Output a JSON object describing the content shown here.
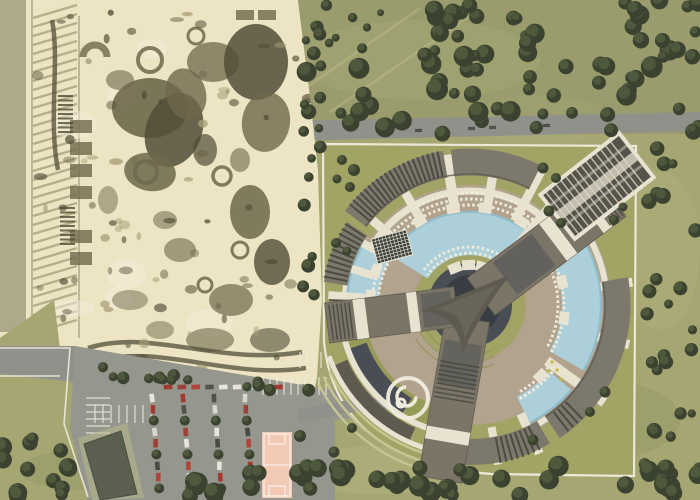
{
  "page": {
    "kind": "aerial-masterplan-rendering",
    "width": 700,
    "height": 500
  },
  "palette": {
    "grass": "#a5a672",
    "forest_field": "#9a9c6d",
    "lawn_light": "#c6c493",
    "lawn_dark": "#8e9254",
    "tree_dark": "#3b4330",
    "tree_mid": "#525c3e",
    "tree_light": "#66714b",
    "sepia_bg": "#ece4c3",
    "ink": "#6f684c",
    "shadow": "#514d38",
    "mid": "#a79e77",
    "sepia_light": "#f4eedd",
    "road": "#90918a",
    "asphalt": "#95968e",
    "line_white": "#f0ecdd",
    "path_white": "#e8e2d0",
    "site_lawn": "#a2a465",
    "deck": "#b1a38d",
    "pool": "#accfd9",
    "pool_deep": "#8fbccb",
    "roof": "#7d786c",
    "roof_dark": "#5e5a50",
    "louver": "#44433b",
    "glass": "#494d54",
    "glass_dark": "#383c43",
    "arm": "#7a7567",
    "court": "#f1c9b4",
    "bldg": "#5b5f50",
    "pad_green": "#b7ba86",
    "car_colors": [
      "#e8e6db",
      "#a23a30",
      "#50544b",
      "#d9d7cd",
      "#9c4038",
      "#e8e6db",
      "#474b43",
      "#b0443a"
    ],
    "yellow_dot": "#c9b94a"
  },
  "scene": {
    "forest_field_rect": [
      282,
      0,
      418,
      134
    ],
    "field_streaks": [
      [
        300,
        92,
        420,
        8
      ],
      [
        330,
        112,
        470,
        16
      ]
    ],
    "mottles": [
      [
        120,
        200,
        90,
        50,
        "#d8d6a6"
      ],
      [
        200,
        320,
        70,
        40,
        "#6f7348"
      ],
      [
        420,
        60,
        120,
        40,
        "#c9c795"
      ],
      [
        600,
        420,
        80,
        40,
        "#6f7348"
      ],
      [
        380,
        470,
        100,
        24,
        "#d8d6a6"
      ],
      [
        660,
        250,
        40,
        80,
        "#c9c795"
      ],
      [
        80,
        470,
        60,
        20,
        "#6f7348"
      ],
      [
        540,
        120,
        70,
        25,
        "#b8b787"
      ]
    ],
    "top_road": "M285,121 L700,112 L700,131 L285,141 Z",
    "road_cars": [
      [
        468,
        127
      ],
      [
        489,
        126
      ],
      [
        543,
        124
      ],
      [
        415,
        129
      ]
    ],
    "park": {
      "clip": "0,0 298,0 310,96 318,170 322,300 317,378 306,428 235,422 120,398 60,350 54,300 0,338",
      "left_strip": [
        0,
        0,
        26,
        332
      ],
      "hatch": {
        "y0": 18,
        "y1": 336,
        "dy": 9,
        "x1": 33,
        "x2": 77,
        "drop": 13
      },
      "blobs": [
        [
          150,
          108,
          38,
          30,
          0,
          "ink",
          0.9
        ],
        [
          174,
          130,
          28,
          38,
          20,
          "shadow",
          0.85
        ],
        [
          186,
          94,
          20,
          26,
          -15,
          "ink",
          0.8
        ],
        [
          150,
          172,
          26,
          19,
          10,
          "ink",
          0.85
        ],
        [
          213,
          62,
          26,
          20,
          0,
          "ink",
          0.75
        ],
        [
          256,
          62,
          32,
          38,
          0,
          "shadow",
          0.85
        ],
        [
          266,
          122,
          24,
          30,
          8,
          "ink",
          0.8
        ],
        [
          250,
          212,
          20,
          27,
          0,
          "ink",
          0.85
        ],
        [
          272,
          262,
          18,
          23,
          0,
          "shadow",
          0.8
        ],
        [
          231,
          300,
          22,
          16,
          0,
          "ink",
          0.7
        ],
        [
          180,
          250,
          16,
          12,
          0,
          "ink",
          0.6
        ],
        [
          120,
          80,
          14,
          10,
          0,
          "ink",
          0.6
        ],
        [
          205,
          150,
          12,
          16,
          0,
          "shadow",
          0.7
        ],
        [
          240,
          160,
          10,
          12,
          0,
          "ink",
          0.6
        ],
        [
          165,
          220,
          12,
          9,
          0,
          "ink",
          0.55
        ],
        [
          130,
          300,
          18,
          10,
          0,
          "ink",
          0.5
        ],
        [
          210,
          340,
          24,
          12,
          0,
          "ink",
          0.6
        ],
        [
          270,
          340,
          20,
          12,
          0,
          "shadow",
          0.6
        ],
        [
          160,
          330,
          14,
          9,
          0,
          "ink",
          0.5
        ],
        [
          108,
          200,
          10,
          14,
          0,
          "ink",
          0.5
        ]
      ],
      "rings": [
        [
          150,
          60,
          12,
          4
        ],
        [
          146,
          172,
          11,
          4
        ],
        [
          222,
          176,
          9,
          3.5
        ],
        [
          196,
          36,
          8,
          3
        ],
        [
          240,
          250,
          8,
          3
        ],
        [
          205,
          285,
          7,
          3
        ]
      ],
      "halfring": [
        95,
        57,
        12,
        7
      ],
      "rects": [
        [
          70,
          120,
          22,
          13
        ],
        [
          70,
          142,
          22,
          13
        ],
        [
          70,
          164,
          22,
          13
        ],
        [
          70,
          186,
          22,
          13
        ],
        [
          70,
          230,
          22,
          13
        ],
        [
          70,
          252,
          22,
          13
        ],
        [
          236,
          10,
          18,
          10
        ],
        [
          258,
          10,
          18,
          10
        ]
      ],
      "tracks": [
        "M88,348 C150,328 220,366 302,352",
        "M92,362 C158,342 228,380 306,368",
        "M98,378 C168,358 238,396 308,386",
        "M52,20 C60,60 48,120 58,170"
      ],
      "ladders": [
        {
          "x": 58,
          "y": 96,
          "n": 9
        },
        {
          "x": 60,
          "y": 208,
          "n": 9
        }
      ],
      "speckles": {
        "n": 95,
        "seed": 41,
        "x": 34,
        "y": 6,
        "w": 276,
        "h": 414
      },
      "lights": {
        "n": 8,
        "seed": 43,
        "x": 60,
        "y": 30,
        "w": 240,
        "h": 360
      }
    },
    "parking": {
      "lot": "75,346 320,388 392,398 392,416 335,420 335,500 88,500 70,428",
      "left_road": "0,346 75,346 75,382 0,374",
      "edge_lines": [
        "M0,348 L70,348 L64,424 L88,497",
        "M0,376 L60,376"
      ],
      "bays": [
        {
          "x0": 86,
          "y0": 398,
          "n": 6,
          "dx": 0,
          "dy": 7,
          "len": 24,
          "dir": "h"
        },
        {
          "x0": 263,
          "y0": 377,
          "n": 10,
          "dx": 7,
          "dy": 0,
          "len": 18,
          "dir": "v"
        },
        {
          "x0": 95,
          "y0": 405,
          "n": 8,
          "dx": 8,
          "dy": 0,
          "len": 18,
          "dir": "v"
        },
        {
          "x0": 300,
          "y0": 352,
          "n": 5,
          "dx": 7,
          "dy": 0,
          "len": 16,
          "dir": "v"
        }
      ],
      "car_cols": {
        "x0": 152,
        "y0": 398,
        "cols": 4,
        "colDx": 31,
        "rows": 9,
        "rowDy": 11.3,
        "slant": 0.9
      },
      "top_row": {
        "x0": 168,
        "y": 387,
        "n": 9,
        "dx": 13.8
      }
    },
    "service_building": {
      "pad": "78,438 127,423 144,498 92,500",
      "body": "84,444 121,431 137,494 100,500"
    },
    "court": {
      "x": 262,
      "y": 432,
      "w": 30,
      "h": 66
    },
    "site": {
      "outline": "M323,144 L636,146 L634,476 L492,474 Q336,462 324,342 Z"
    },
    "road_to_site": "M298,416 Q330,410 352,406 L398,402",
    "complex": {
      "cx": 470,
      "cy": 305,
      "discs": [
        {
          "r": 120,
          "c": "deck"
        },
        {
          "r": 56,
          "c": "site_lawn"
        },
        {
          "r": 42,
          "c": "glass"
        },
        {
          "r": 30,
          "c": "glass_dark"
        }
      ],
      "deck_arcs": [
        {
          "r": 126,
          "w": 30,
          "a1": -65,
          "a2": 35,
          "c": "deck"
        },
        {
          "r": 110,
          "w": 30,
          "a1": 146,
          "a2": 188,
          "c": "deck"
        }
      ],
      "amphi": [
        {
          "r": 50,
          "a1": 205,
          "a2": 300
        },
        {
          "r": 57,
          "a1": 208,
          "a2": 296
        },
        {
          "r": 64,
          "a1": 212,
          "a2": 292
        }
      ],
      "bl_arcs": [
        {
          "r": 118,
          "w": 24,
          "a1": 197,
          "a2": 250,
          "c": "#969b58"
        },
        {
          "r": 120,
          "w": 20,
          "a1": 200,
          "a2": 238,
          "c": "glass"
        },
        {
          "r": 142,
          "w": 15,
          "a1": 204,
          "a2": 246,
          "c": "roof_dark"
        },
        {
          "r": 155,
          "w": 2.5,
          "a1": 205,
          "a2": 258,
          "c": "lawn_light"
        },
        {
          "r": 163,
          "w": 2.5,
          "a1": 206,
          "a2": 258,
          "c": "lawn_light"
        },
        {
          "r": 171,
          "w": 2.5,
          "a1": 208,
          "a2": 256,
          "c": "lawn_light"
        }
      ],
      "white_rings": [
        {
          "r": 114,
          "w": 7,
          "a1": 45,
          "a2": 150
        },
        {
          "r": 137,
          "w": 6,
          "a1": -60,
          "a2": 35
        },
        {
          "r": 126,
          "w": 5,
          "a1": 148,
          "a2": 190
        },
        {
          "r": 130,
          "w": 6,
          "a1": 196,
          "a2": 258
        },
        {
          "r": 150,
          "w": 5,
          "a1": 200,
          "a2": 256
        }
      ],
      "pools": [
        {
          "r": 72,
          "w": 44,
          "a1": 52,
          "a2": 148
        },
        {
          "r": 112,
          "w": 40,
          "a1": -30,
          "a2": 30
        },
        {
          "r": 118,
          "w": 30,
          "a1": -63,
          "a2": -40
        },
        {
          "r": 108,
          "w": 32,
          "a1": 150,
          "a2": 183
        }
      ],
      "loungers": [
        [
          100,
          50,
          150
        ],
        [
          106,
          48,
          150
        ],
        [
          52,
          55,
          145
        ],
        [
          58,
          56,
          144
        ],
        [
          88,
          -28,
          28
        ],
        [
          94,
          -30,
          26
        ],
        [
          92,
          150,
          184
        ],
        [
          98,
          152,
          186
        ],
        [
          100,
          -60,
          -36
        ],
        [
          106,
          -62,
          -38
        ],
        [
          112,
          60,
          120
        ]
      ],
      "spokes": [
        [
          50,
          60,
          152,
          13
        ],
        [
          62,
          95,
          152,
          9
        ],
        [
          80,
          95,
          152,
          9
        ],
        [
          99,
          95,
          152,
          10
        ],
        [
          120,
          95,
          152,
          9
        ],
        [
          139,
          95,
          152,
          9
        ],
        [
          150,
          95,
          140,
          8
        ],
        [
          163,
          100,
          140,
          8
        ],
        [
          176,
          104,
          142,
          8
        ],
        [
          33,
          130,
          162,
          9
        ],
        [
          8,
          132,
          164,
          9
        ],
        [
          -14,
          132,
          164,
          9
        ],
        [
          -36,
          95,
          166,
          10
        ],
        [
          -65,
          120,
          164,
          9
        ],
        [
          -80,
          124,
          162,
          8
        ]
      ],
      "pavilions": [
        [
          58,
          98
        ],
        [
          81,
          98
        ],
        [
          100,
          98
        ],
        [
          121,
          98
        ],
        [
          141,
          98
        ],
        [
          72,
          40
        ],
        [
          92,
          40
        ],
        [
          112,
          40
        ],
        [
          -8,
          95
        ],
        [
          14,
          95
        ],
        [
          -45,
          100
        ],
        [
          160,
          100
        ],
        [
          175,
          100
        ]
      ],
      "outer_roofs": [
        {
          "r": 143,
          "w": 27,
          "a1": 100,
          "a2": 143
        },
        {
          "r": 143,
          "w": 27,
          "a1": 63,
          "a2": 97
        },
        {
          "r": 136,
          "w": 24,
          "a1": 146,
          "a2": 171
        },
        {
          "r": 147,
          "w": 27,
          "a1": -56,
          "a2": 10
        },
        {
          "r": 147,
          "w": 26,
          "a1": -92,
          "a2": -60
        }
      ],
      "roof_edges": [
        {
          "r": 131,
          "w": 1.5,
          "a1": 63,
          "a2": 143
        },
        {
          "r": 135,
          "w": 1.5,
          "a1": -56,
          "a2": 10
        }
      ],
      "louver_fans": [
        {
          "a1": 102,
          "a2": 141,
          "r1": 131,
          "r2": 157,
          "step": 1.9
        },
        {
          "a1": 147,
          "a2": 170,
          "r1": 125,
          "r2": 149,
          "step": 2.2
        },
        {
          "a1": 178,
          "a2": 197,
          "r1": 121,
          "r2": 141,
          "step": 2.4
        },
        {
          "a1": -79,
          "a2": -64,
          "r1": 135,
          "r2": 161,
          "step": 2.1
        },
        {
          "a1": -52,
          "a2": -44,
          "r1": 136,
          "r2": 160,
          "step": 2.2
        }
      ],
      "grid_pavilion": {
        "x": 392,
        "y": 247,
        "w": 36,
        "h": 26,
        "rot": -15
      },
      "arms": [
        {
          "rot": -37,
          "len": 178,
          "w": 46,
          "bands": [
            [
              104,
              13
            ],
            [
              150,
              11
            ]
          ],
          "glass": [
            44,
            48,
            0.5
          ],
          "ribs": [
            160,
            176,
            4
          ]
        },
        {
          "rot": 99.7,
          "len": 177,
          "w": 44,
          "bands": [
            [
              126,
              13
            ]
          ],
          "glass": [
            38,
            44,
            0.45
          ],
          "ribs": [
            60,
            96,
            4.5
          ]
        },
        {
          "rot": 172.8,
          "len": 144,
          "w": 40,
          "bands": [
            [
              52,
              10
            ],
            [
              104,
              12
            ]
          ],
          "glass": [
            18,
            30,
            0.45
          ],
          "ribs": [
            120,
            140,
            4
          ]
        }
      ],
      "triangle": {
        "r": 50,
        "ctrl": 13,
        "angles": [
          -37,
          99.7,
          172.8
        ],
        "inner_r": 34,
        "inner_ctrl": 9,
        "inner_fill": "#6a665b"
      },
      "wing": {
        "x": 597,
        "y": 186,
        "rot": -38,
        "w": 104,
        "h": 60
      },
      "yellow_dots": [
        [
          552,
          362
        ],
        [
          557,
          370
        ],
        [
          548,
          371
        ],
        [
          561,
          379
        ]
      ],
      "spiral": {
        "x": 408,
        "y": 398
      }
    },
    "site_trees": [
      [
        342,
        160,
        5
      ],
      [
        354,
        170,
        6
      ],
      [
        337,
        179,
        4.5
      ],
      [
        350,
        187,
        5
      ],
      [
        543,
        168,
        5.5
      ],
      [
        556,
        178,
        5
      ],
      [
        549,
        211,
        5.5
      ],
      [
        561,
        223,
        5
      ],
      [
        336,
        243,
        5
      ],
      [
        347,
        251,
        4.5
      ],
      [
        614,
        220,
        5
      ],
      [
        623,
        207,
        4.5
      ],
      [
        605,
        392,
        5.5
      ],
      [
        590,
        412,
        5
      ],
      [
        533,
        440,
        5.5
      ],
      [
        352,
        428,
        5
      ],
      [
        334,
        452,
        5.5
      ],
      [
        300,
        436,
        6
      ]
    ],
    "tree_clusters": [
      {
        "name": "forest-band",
        "x": 285,
        "y": 46,
        "w": 415,
        "h": 88,
        "n": 56,
        "rmin": 5,
        "rmax": 11,
        "seed": 7
      },
      {
        "name": "forest-top-mid",
        "x": 430,
        "y": 0,
        "w": 130,
        "h": 46,
        "n": 16,
        "rmin": 5,
        "rmax": 10,
        "seed": 11
      },
      {
        "name": "forest-top-right",
        "x": 612,
        "y": 0,
        "w": 88,
        "h": 58,
        "n": 13,
        "rmin": 5,
        "rmax": 10,
        "seed": 13
      },
      {
        "name": "field-sparse",
        "x": 300,
        "y": 2,
        "w": 120,
        "h": 50,
        "n": 6,
        "rmin": 3,
        "rmax": 6,
        "seed": 17
      },
      {
        "name": "east-margin",
        "x": 644,
        "y": 148,
        "w": 54,
        "h": 336,
        "n": 26,
        "rmin": 4,
        "rmax": 8,
        "seed": 19
      },
      {
        "name": "south-band",
        "x": 175,
        "y": 466,
        "w": 525,
        "h": 32,
        "n": 46,
        "rmin": 6,
        "rmax": 11,
        "seed": 23
      },
      {
        "name": "southwest-corner",
        "x": 0,
        "y": 438,
        "w": 72,
        "h": 60,
        "n": 13,
        "rmin": 6,
        "rmax": 11,
        "seed": 29
      },
      {
        "name": "park-edge",
        "x": 301,
        "y": 14,
        "w": 20,
        "h": 292,
        "n": 17,
        "rmin": 4,
        "rmax": 7,
        "seed": 31
      },
      {
        "name": "parking-row",
        "x": 95,
        "y": 366,
        "w": 215,
        "h": 12,
        "n": 17,
        "rmin": 4.5,
        "rmax": 6.5,
        "seed": 37,
        "slope": 0.09
      }
    ]
  }
}
